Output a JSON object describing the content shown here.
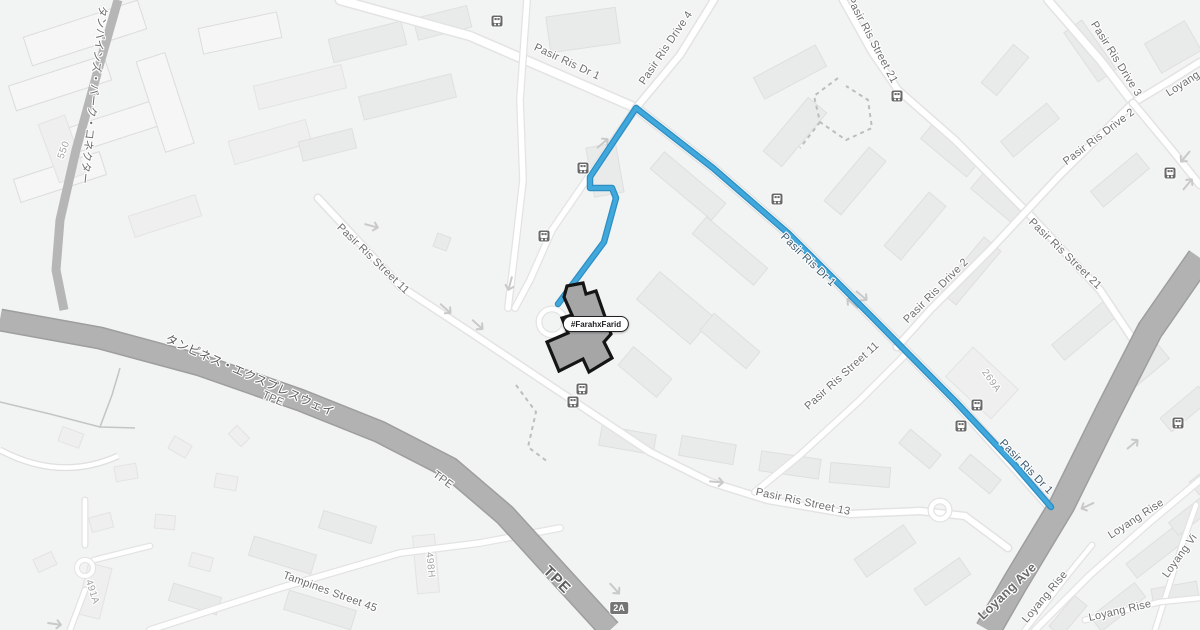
{
  "map": {
    "place": {
      "label": "#FarahxFarid"
    },
    "exit_badge": {
      "text": "2A"
    },
    "road_labels": [
      {
        "text": "Pasir Ris Dr 1"
      },
      {
        "text": "Pasir Ris Drive 4"
      },
      {
        "text": "Pasir Ris Street 21"
      },
      {
        "text": "Pasir Ris Drive 3"
      },
      {
        "text": "Loyang"
      },
      {
        "text": "Pasir Ris Drive 2"
      },
      {
        "text": "Pasir Ris Street 21"
      },
      {
        "text": "Pasir Ris Drive 2"
      },
      {
        "text": "Pasir Ris Street 11"
      },
      {
        "text": "Pasir Ris Street 11"
      },
      {
        "text": "Pasir Ris Dr 1"
      },
      {
        "text": "Pasir Ris Dr 1"
      },
      {
        "text": "Pasir Ris Street 13"
      },
      {
        "text": "Loyang Ave"
      },
      {
        "text": "Loyang Rise"
      },
      {
        "text": "Loyang Rise"
      },
      {
        "text": "Loyang Rise"
      },
      {
        "text": "Loyang Vi"
      },
      {
        "text": "タンピネス・エクスプレスウェイ"
      },
      {
        "text": "TPE"
      },
      {
        "text": "TPE"
      },
      {
        "text": "TPE"
      },
      {
        "text": "タンパインズ・パーク・コネクター"
      },
      {
        "text": "Tampines Street 45"
      }
    ],
    "building_labels": [
      {
        "text": "550"
      },
      {
        "text": "491A"
      },
      {
        "text": "498H"
      },
      {
        "text": "269A"
      }
    ],
    "colors": {
      "background": "#f2f3f3",
      "route": "#41a8dc",
      "route_casing": "#2d8ec4",
      "expressway_fill": "#b2b2b2",
      "expressway_casing": "#9e9e9e",
      "road_fill": "#ffffff",
      "road_casing": "#e3e3e3",
      "building_fill": "#e9eaea",
      "highlight_fill": "#a6a6a6",
      "highlight_outline": "#151515",
      "label_text": "#6e6e6e",
      "bus_icon": "#6a6a6a",
      "exit_badge": "#757575"
    }
  }
}
